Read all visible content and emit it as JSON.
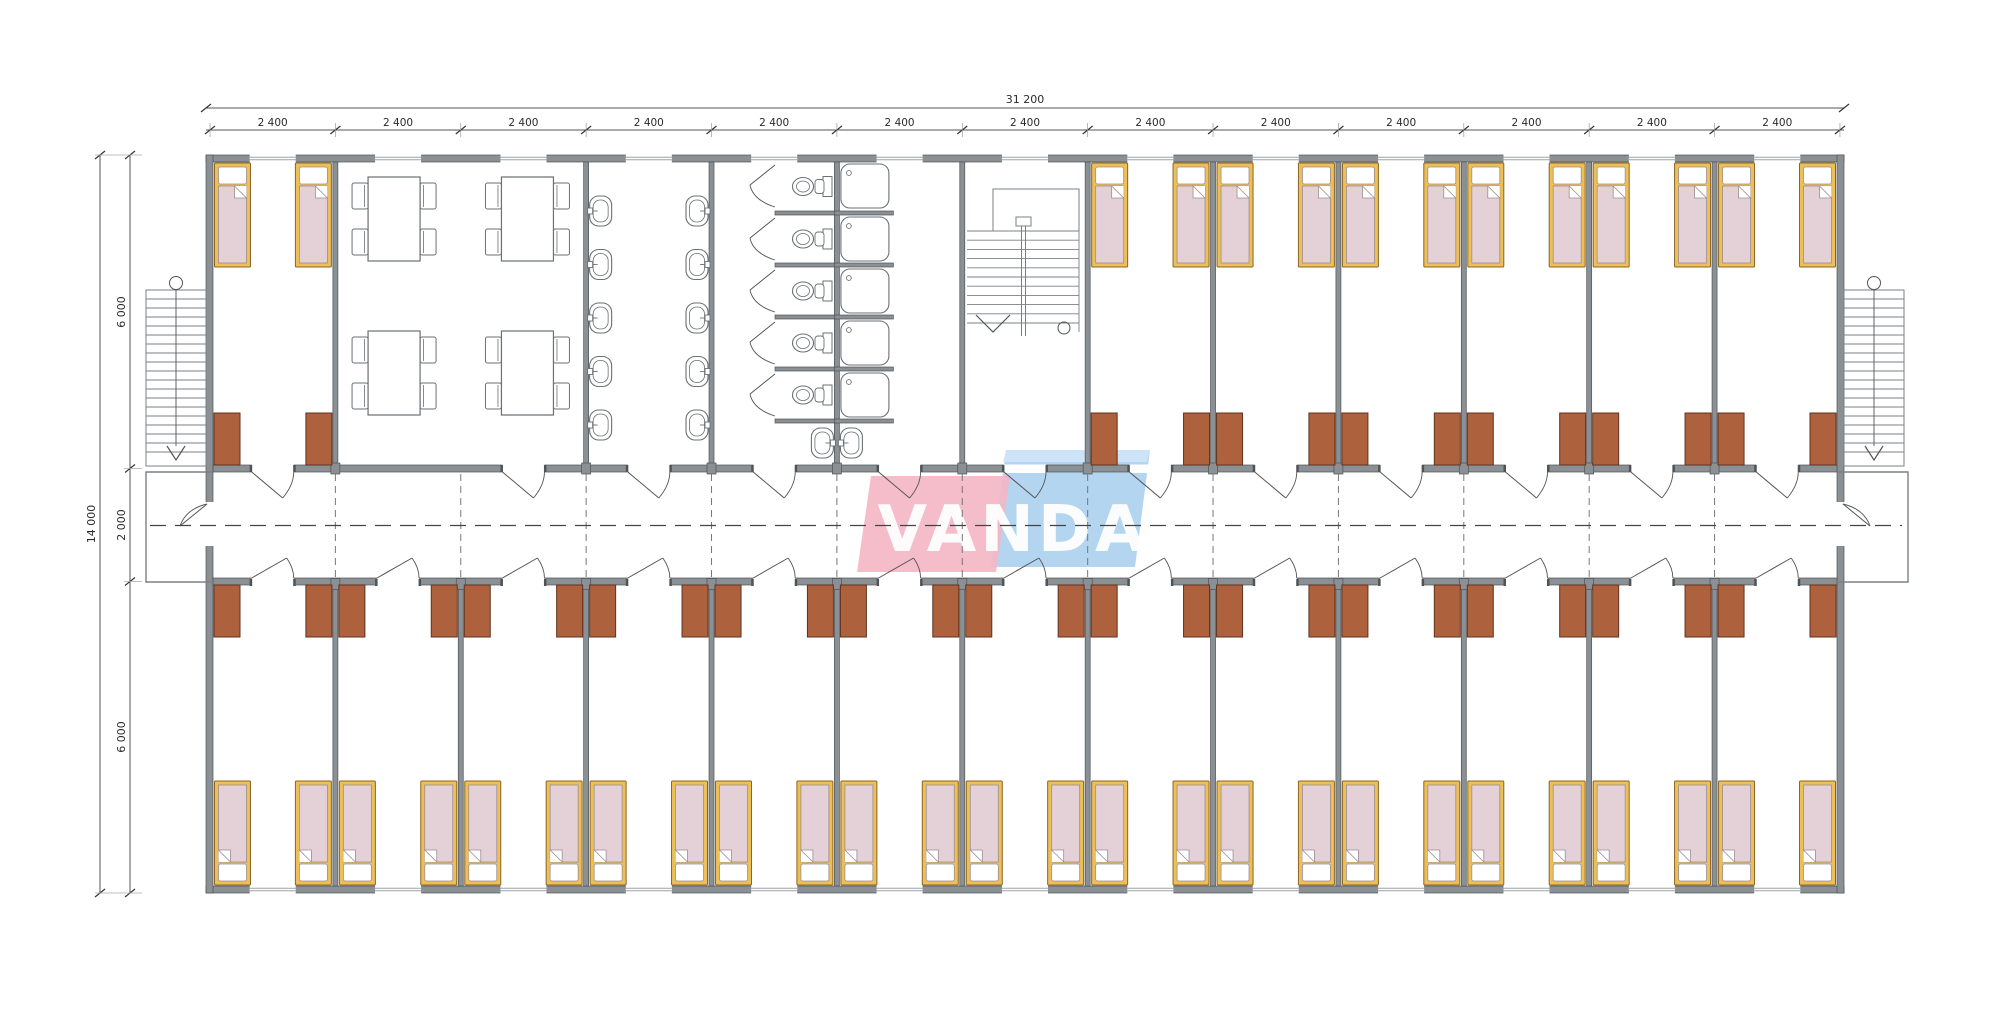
{
  "logo": {
    "text": "VANDA"
  },
  "dimensions": {
    "top_total": "31 200",
    "top_modules": [
      "2 400",
      "2 400",
      "2 400",
      "2 400",
      "2 400",
      "2 400",
      "2 400",
      "2 400",
      "2 400",
      "2 400",
      "2 400",
      "2 400",
      "2 400"
    ],
    "left_total": "14 000",
    "left_segments": [
      "6 000",
      "2 000",
      "6 000"
    ]
  },
  "colors": {
    "wall": "#8a9093",
    "wall_dark": "#4e5357",
    "fixture": "#6a7074",
    "stair": "#7a8084",
    "bed_frame": "#edbf58",
    "bed_frame_dark": "#8a6526",
    "mattress": "#e4d0d7",
    "mattress_dark": "#9c8d93",
    "wardrobe": "#ad613d",
    "wardrobe_dark": "#613220",
    "logo_pink": "#f4b6c6",
    "logo_blue": "#abd0ee",
    "logo_blue_light": "#cfe5f8",
    "dim_line": "#555555",
    "centerline": "#444444"
  },
  "plan": {
    "total_modules": 13,
    "module_width_mm": 2400,
    "building_length_mm": 31200,
    "building_depth_mm": 14000,
    "wing_depth_mm": 6000,
    "corridor_width_mm": 2000,
    "top_row_rooms": [
      "bedroom",
      "dining-hall",
      "dining-hall",
      "washroom",
      "wc",
      "showers",
      "staircase",
      "bedroom",
      "bedroom",
      "bedroom",
      "bedroom",
      "bedroom",
      "bedroom"
    ],
    "bottom_row_rooms": [
      "bedroom",
      "bedroom",
      "bedroom",
      "bedroom",
      "bedroom",
      "bedroom",
      "bedroom",
      "bedroom",
      "bedroom",
      "bedroom",
      "bedroom",
      "bedroom",
      "bedroom"
    ],
    "counts": {
      "beds": 40,
      "wardrobes": 40,
      "dining_tables": 4,
      "dining_chairs": 16,
      "washbasins": 12,
      "wc_stalls": 5,
      "shower_stalls": 5,
      "exterior_stairs": 2,
      "central_stairs": 1
    }
  }
}
